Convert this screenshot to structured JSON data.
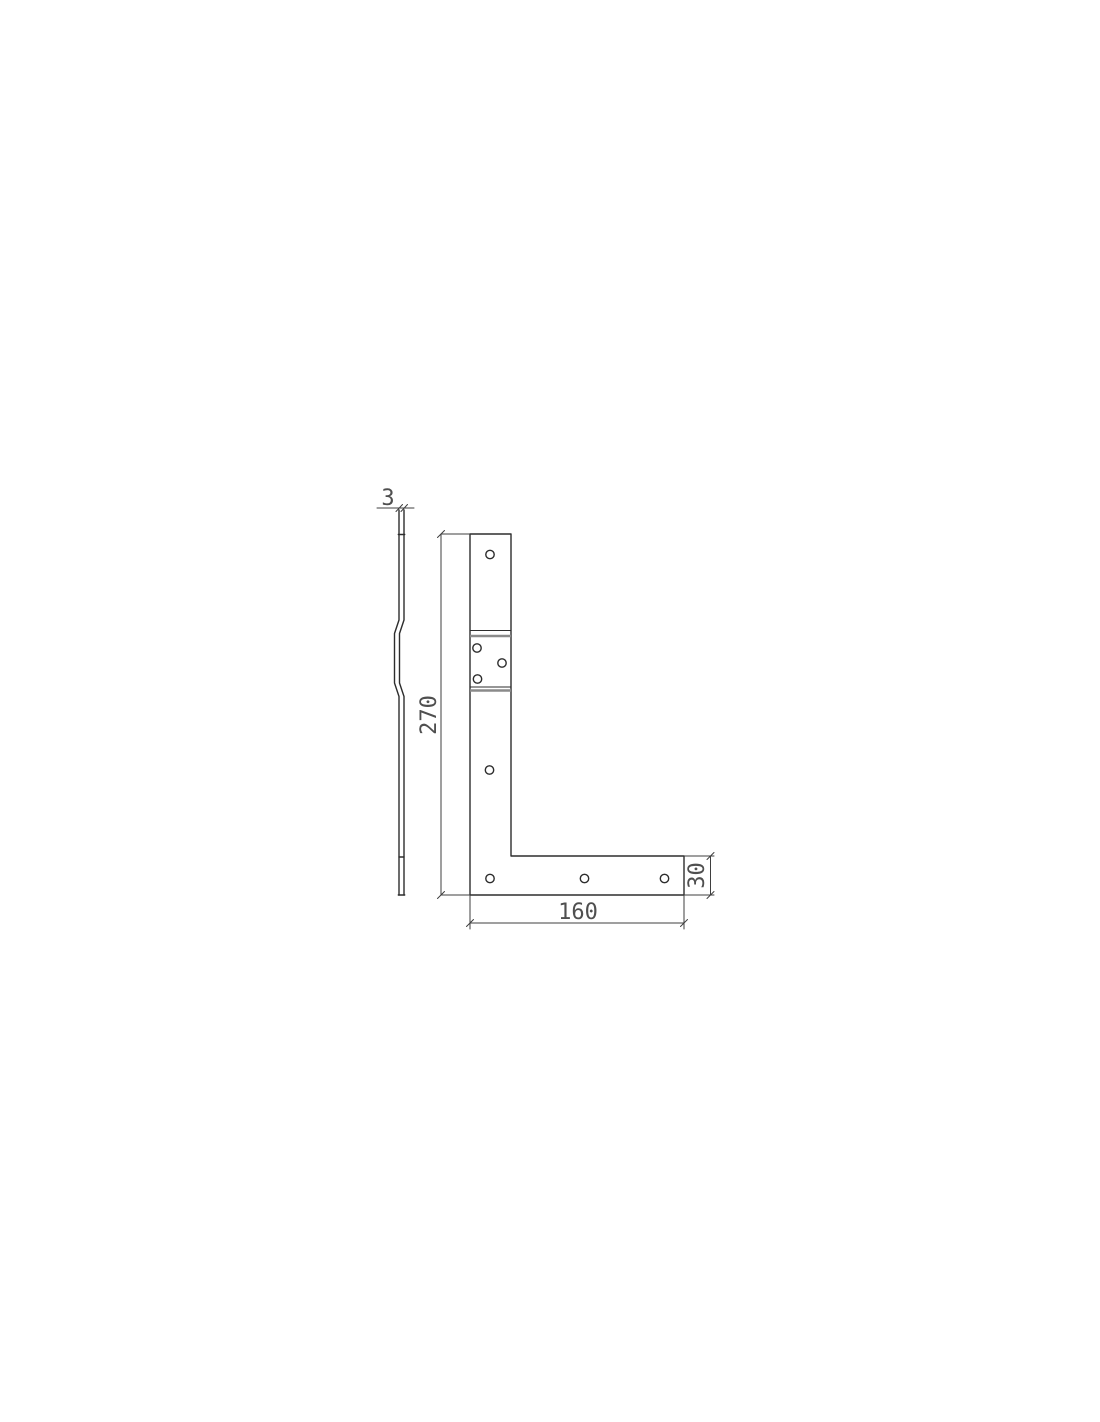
{
  "drawing": {
    "title": "L-shaped corner bracket technical drawing",
    "dimensions": {
      "thickness_label": "3",
      "height_label": "270",
      "bottom_length_label": "160",
      "leg_width_label": "30"
    },
    "colors": {
      "background": "#ffffff",
      "line": "#2d2d2d",
      "dim_line": "#3f3f3f",
      "bend_line": "#8a8a8a",
      "text": "#4f4f4f"
    }
  }
}
